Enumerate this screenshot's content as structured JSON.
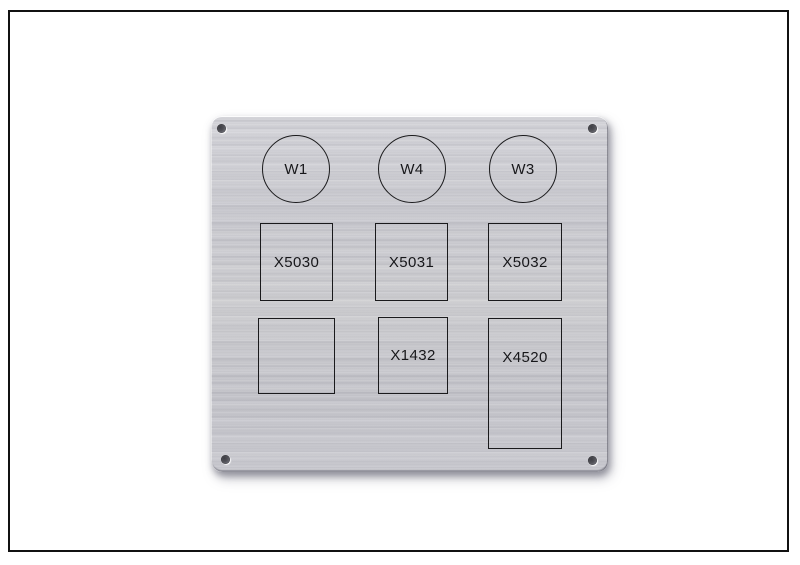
{
  "panel": {
    "circle_labels": [
      {
        "label": "W1"
      },
      {
        "label": "W4"
      },
      {
        "label": "W3"
      }
    ],
    "row1_labels": [
      {
        "label": "X5030"
      },
      {
        "label": "X5031"
      },
      {
        "label": "X5032"
      }
    ],
    "row2_labels": [
      {
        "label": ""
      },
      {
        "label": "X1432"
      },
      {
        "label": "X4520"
      }
    ],
    "colors": {
      "background": "#ffffff",
      "frame_border": "#111111",
      "metal_light": "#d3d3d8",
      "metal_base": "#c7c7cd",
      "metal_dark": "#c2c2c8",
      "engraving": "#1a1a1c"
    }
  }
}
